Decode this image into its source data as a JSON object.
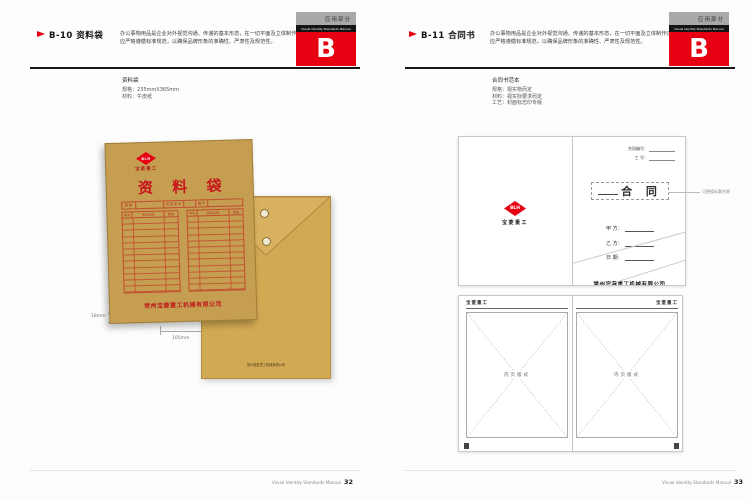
{
  "colors": {
    "accent_red": "#e60012",
    "kraft_front": "#c59e51",
    "kraft_back": "#d2a953",
    "table_line_red": "#c13e28"
  },
  "header_tab": {
    "section_label": "应用部分",
    "manual_label": "Visual Identity Standards Manual",
    "section_letter": "B"
  },
  "left": {
    "code_title": "B-10 资料袋",
    "description": "办公事物用品是企业对外视觉沟通、传递的基本形态，在一切平面及立体制作过程中都应严格遵循标准规范，以确保品牌形象的准确性、严肃性及规范性。",
    "spec_name": "资料袋",
    "spec_size": "规格：235mmX365mm",
    "spec_material": "材料：牛皮纸",
    "envelope": {
      "logo_mark": "BLH",
      "logo_name": "宝菱重工",
      "bag_title": "资 料 袋",
      "table_label_1": "案卷",
      "table_label_2": "全宗序号",
      "table_label_3": "编号",
      "col_seq": "序号",
      "col_name": "资料名称",
      "col_qty": "数量",
      "company": "常州宝菱重工机械有限公司"
    },
    "back_company": "常州宝菱重工机械有限公司",
    "dim_side": "18mm",
    "dim_bottom": "105mm",
    "footer_text": "Visual Identity Standards Manual",
    "footer_page": "32"
  },
  "right": {
    "code_title": "B-11 合同书",
    "description": "办公事物用品是企业对外视觉沟通、传递的基本形态，在一切平面及立体制作过程中都应严格遵循标准规范，以确保品牌形象的准确性、严肃性及规范性。",
    "spec_name": "合同书范本",
    "spec_size": "规格：视实物而定",
    "spec_material": "材料：视实际要求而定",
    "spec_craft": "工艺：封面标志印专版",
    "cover": {
      "logo_mark": "BLH",
      "logo_name": "宝菱重工",
      "contract_no_label": "合同编号：",
      "work_no_label": "工 号：",
      "title": "合 同",
      "annotation": "可更换标题名称",
      "field_a": "甲 方：",
      "field_b": "乙 方：",
      "field_c": "日 期：",
      "company": "常州宝菱重工机械有限公司"
    },
    "inner": {
      "brand": "宝菱重工",
      "placeholder": "内页版式"
    },
    "footer_text": "Visual Identity Standards Manual",
    "footer_page": "33"
  }
}
